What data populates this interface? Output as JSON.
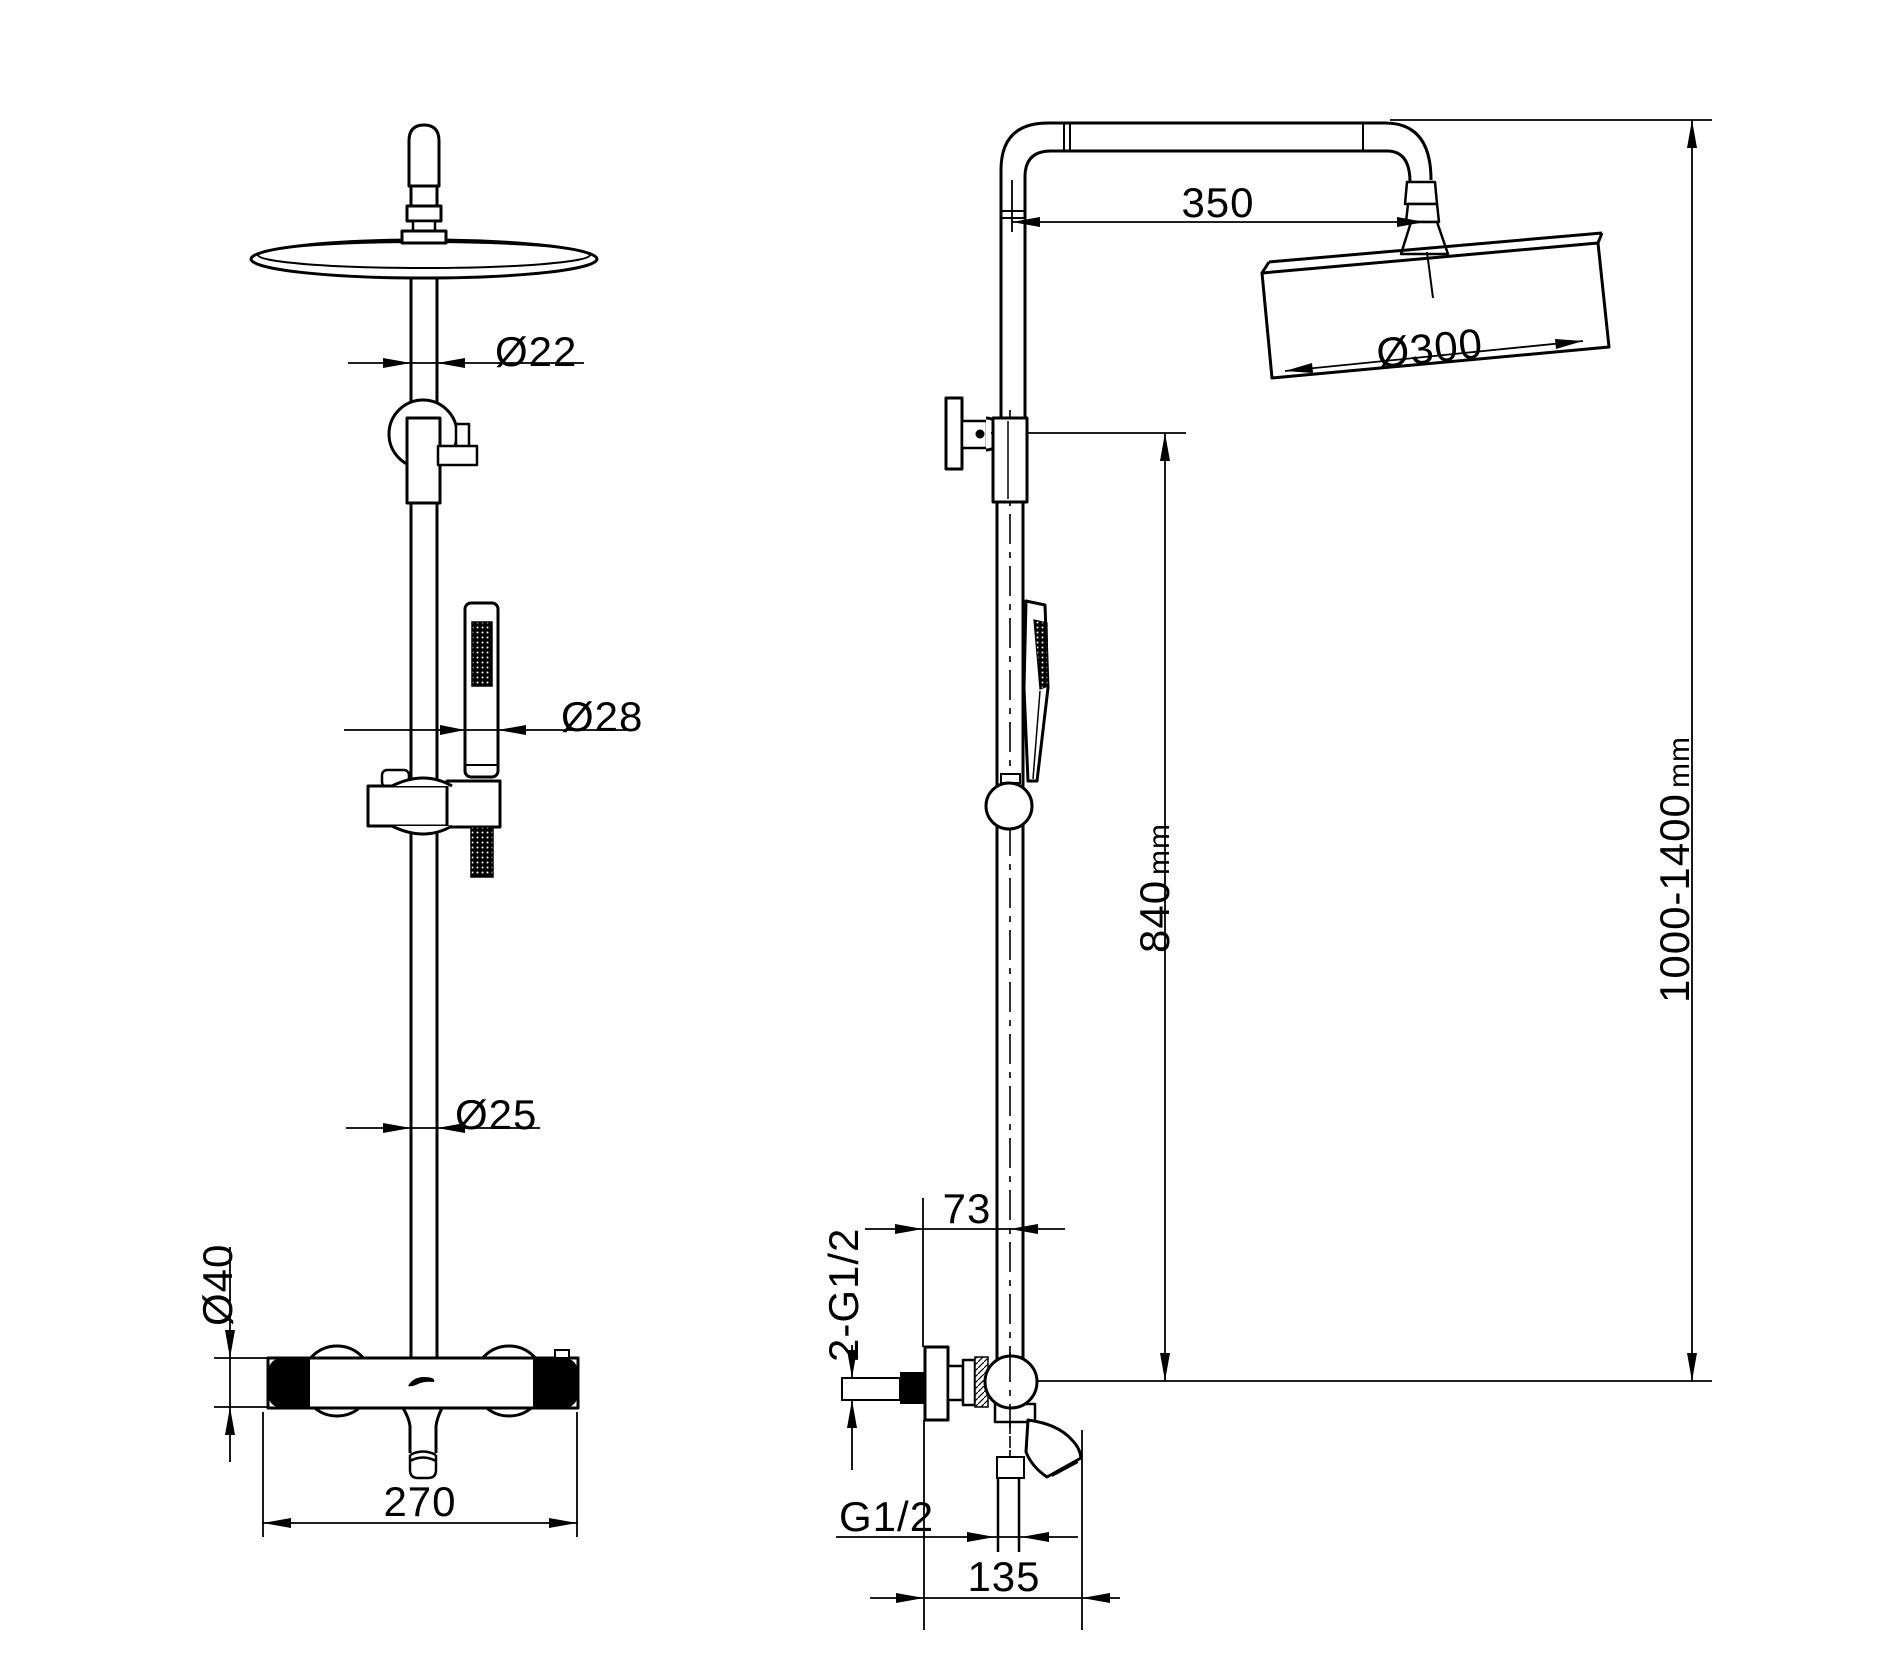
{
  "page": {
    "background": "#ffffff",
    "line_color": "#000000",
    "kind": "shower-system-technical-drawing"
  },
  "front_view": {
    "pipe_above_head": "Ø22",
    "hand_shower": "Ø28",
    "riser": "Ø25",
    "valve_body": "Ø40",
    "valve_width": "270"
  },
  "side_view": {
    "arm_reach": "350",
    "head_dia": "Ø300",
    "height_to_bracket": "840",
    "height_to_bracket_unit": "mm",
    "total_height": "1000-1400",
    "total_height_unit": "mm",
    "wall_to_riser": "73",
    "inlet_thread": "2-G1/2",
    "hose_thread": "G1/2",
    "spout_reach": "135"
  }
}
